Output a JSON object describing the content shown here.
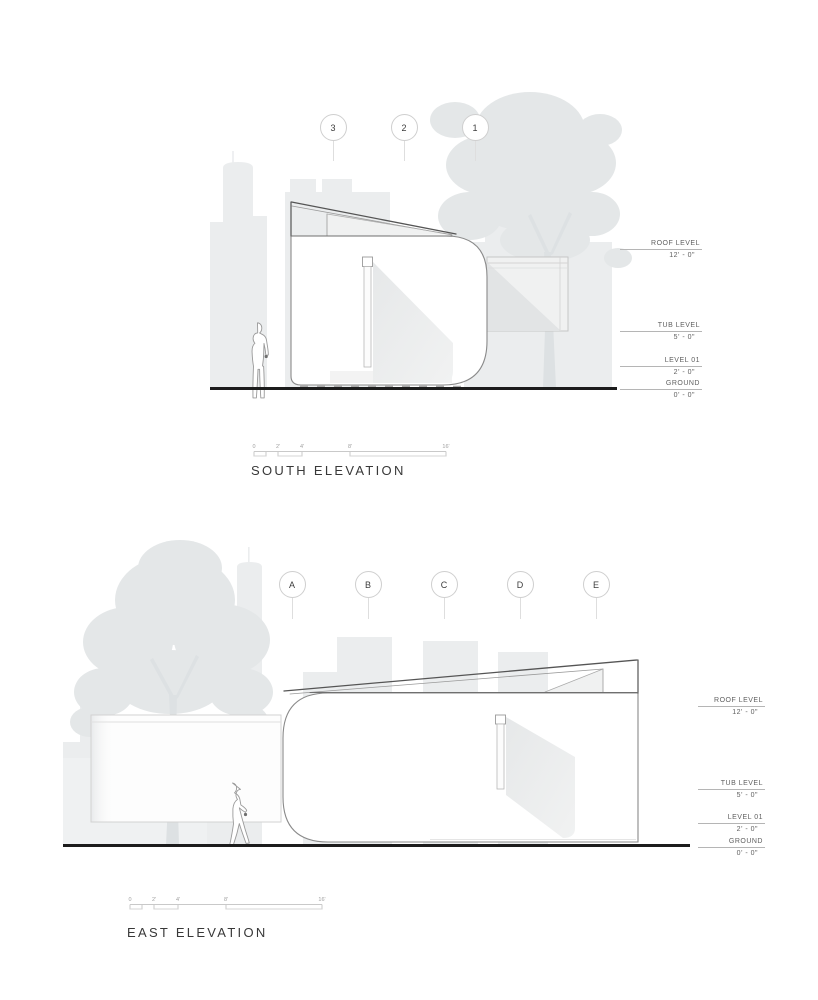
{
  "sheet": {
    "background": "#ffffff"
  },
  "south": {
    "title": "SOUTH ELEVATION",
    "grid_markers": [
      "3",
      "2",
      "1"
    ],
    "levels": [
      {
        "name": "ROOF LEVEL",
        "dim": "12' - 0\""
      },
      {
        "name": "TUB LEVEL",
        "dim": "5' - 0\""
      },
      {
        "name": "LEVEL 01",
        "dim": "2' - 0\""
      },
      {
        "name": "GROUND",
        "dim": "0' - 0\""
      }
    ],
    "scale_ticks": [
      "0",
      "2'",
      "4'",
      "8'",
      "16'"
    ]
  },
  "east": {
    "title": "EAST ELEVATION",
    "grid_markers": [
      "A",
      "B",
      "C",
      "D",
      "E"
    ],
    "levels": [
      {
        "name": "ROOF LEVEL",
        "dim": "12' - 0\""
      },
      {
        "name": "TUB LEVEL",
        "dim": "5' - 0\""
      },
      {
        "name": "LEVEL 01",
        "dim": "2' - 0\""
      },
      {
        "name": "GROUND",
        "dim": "0' - 0\""
      }
    ],
    "scale_ticks": [
      "0",
      "2'",
      "4'",
      "8'",
      "16'"
    ]
  },
  "colors": {
    "ground_line": "#1c1c1c",
    "skyline_silhouette": "#ebedee",
    "tree_silhouette": "#e4e7e8",
    "building_outline": "#8a8a8a",
    "roof_edge": "#555555",
    "cast_shadow": "#e9eaeb",
    "level_text": "#5f5f5f",
    "title_text": "#383838"
  }
}
